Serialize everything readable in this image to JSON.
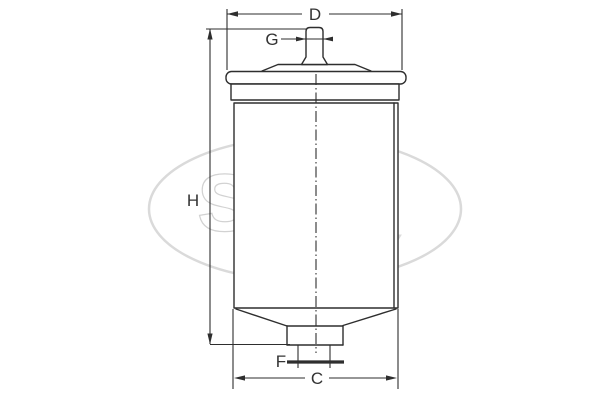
{
  "title": "Fuel filter dimensional drawing",
  "diagram": {
    "dimensions": {
      "top_diameter": "D",
      "inlet_thread": "G",
      "total_height": "H",
      "outlet_thread": "F",
      "body_diameter": "C"
    },
    "watermark": {
      "brand": "SCT",
      "registered_mark": "®",
      "country": "GERMANY"
    },
    "colors": {
      "line": "#2e2e2e",
      "label_text": "#333333",
      "watermark_gray": "#d6d6d6",
      "background": "#ffffff"
    }
  }
}
